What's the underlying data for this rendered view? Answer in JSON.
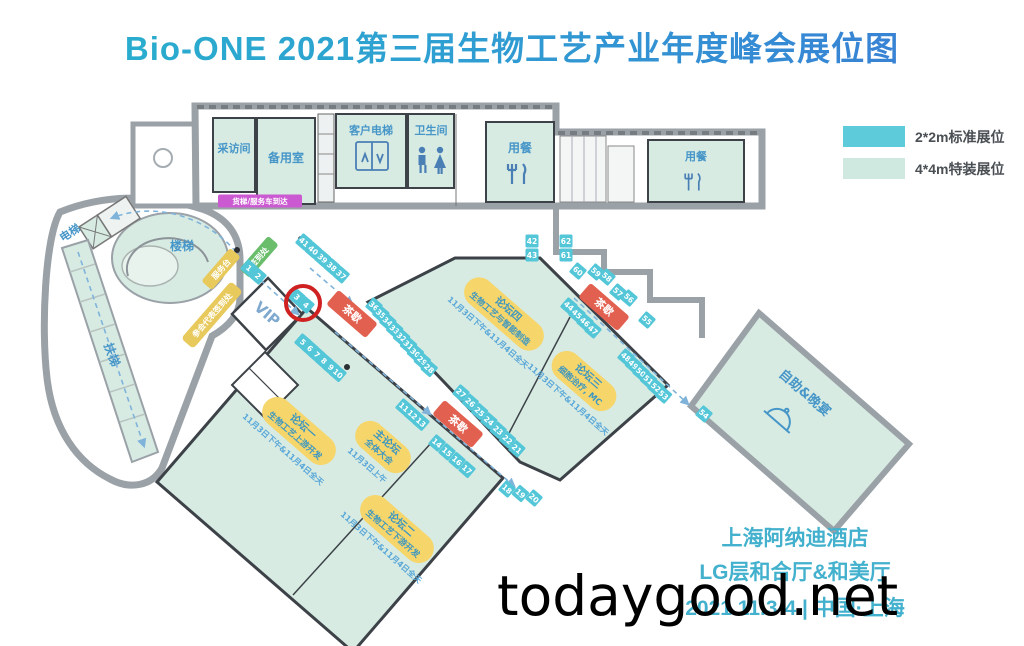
{
  "title": "Bio-ONE 2021第三届生物工艺产业年度峰会展位图",
  "legend": {
    "items": [
      {
        "label": "2*2m标准展位",
        "color": "#5ecbdb"
      },
      {
        "label": "4*4m特装展位",
        "color": "#cfe8e0"
      }
    ]
  },
  "footer": {
    "line1": "上海阿纳迪酒店",
    "line2": "LG层和合厅&和美厅",
    "line3": "2021.11.3-4 | 中国·上海"
  },
  "watermark": "todaygood.net",
  "map": {
    "booth_color": "#53c6d8",
    "wall_gray": "#9aa1a7",
    "room_fill": "#d7ebe3",
    "highlight_color": "#cf2121",
    "rooms": {
      "interview": "采访间",
      "spare": "备用室",
      "elevator_customer": "客户电梯",
      "toilet": "卫生间",
      "dining1": "用餐",
      "dining2": "用餐",
      "elevator": "电梯",
      "stairs": "楼梯",
      "escalator": "扶梯",
      "vip": "VIP",
      "buffet": "自助&晚宴"
    },
    "service_labels": {
      "freight": "货梯/服务车到达",
      "checkin_green": "签到处",
      "service_desk": "服务台",
      "registration": "参会代表签到处"
    },
    "tea_break_label": "茶歇",
    "tea_breaks": [
      {
        "x": 352,
        "y": 314
      },
      {
        "x": 458,
        "y": 424
      },
      {
        "x": 604,
        "y": 307
      }
    ],
    "forums": [
      {
        "name": "论坛一",
        "line2": "生物工艺上游开发",
        "date": "11月3日下午&11月4日全天",
        "x": 299,
        "y": 431,
        "w": 88
      },
      {
        "name": "主论坛",
        "line2": "全体大会",
        "date": "11月3日上午",
        "x": 383,
        "y": 447,
        "w": 64
      },
      {
        "name": "论坛二",
        "line2": "生物工艺下游开发",
        "date": "11月3日下午&11月4日全天",
        "x": 397,
        "y": 529,
        "w": 88
      },
      {
        "name": "论坛四",
        "line2": "生物工艺与智能制造",
        "date": "11月3日下午&11月4日全天",
        "x": 504,
        "y": 314,
        "w": 96
      },
      {
        "name": "论坛三",
        "line2": "细胞治疗, MC",
        "date": "11月3日下午&11月4日全天",
        "x": 584,
        "y": 381,
        "w": 76
      }
    ],
    "booth_strips": [
      {
        "nums": [
          1,
          2
        ],
        "x": 249,
        "y": 268,
        "dx": 9,
        "dy": 8,
        "angle": 41
      },
      {
        "nums": [
          3,
          4
        ],
        "x": 297,
        "y": 297,
        "dx": 9,
        "dy": 8,
        "angle": 41
      },
      {
        "nums": [
          5,
          6,
          7,
          8,
          9,
          10
        ],
        "x": 303,
        "y": 342,
        "dx": 7,
        "dy": 6.3,
        "angle": 41
      },
      {
        "nums": [
          11,
          12,
          13
        ],
        "x": 404,
        "y": 407,
        "dx": 8.5,
        "dy": 7.6,
        "angle": 41
      },
      {
        "nums": [
          14,
          15,
          16,
          17
        ],
        "x": 437,
        "y": 443,
        "dx": 10,
        "dy": 8.8,
        "angle": 41
      },
      {
        "nums": [
          18,
          19,
          20
        ],
        "x": 507,
        "y": 489,
        "dx": 13.5,
        "dy": 4.5,
        "angle": 41
      },
      {
        "nums": [
          27,
          26,
          25,
          24,
          23,
          22,
          21
        ],
        "x": 461,
        "y": 393,
        "dx": 9.3,
        "dy": 9.3,
        "angle": 41
      },
      {
        "nums": [
          36,
          35,
          34,
          33,
          32,
          31,
          30,
          29,
          28
        ],
        "x": 374,
        "y": 306,
        "dx": 6.9,
        "dy": 7.8,
        "angle": 41
      },
      {
        "nums": [
          41,
          40,
          39,
          38,
          37
        ],
        "x": 304,
        "y": 242,
        "dx": 9.3,
        "dy": 8.2,
        "angle": 41
      },
      {
        "nums": [
          42,
          43
        ],
        "x": 532,
        "y": 241,
        "dx": 0,
        "dy": 14,
        "angle": 0
      },
      {
        "nums": [
          62,
          61
        ],
        "x": 566,
        "y": 241,
        "dx": 0,
        "dy": 14,
        "angle": 0
      },
      {
        "nums": [
          60
        ],
        "x": 578,
        "y": 271,
        "dx": 0,
        "dy": 0,
        "angle": 41
      },
      {
        "nums": [
          59,
          58
        ],
        "x": 596,
        "y": 272,
        "dx": 11,
        "dy": 5,
        "angle": 41
      },
      {
        "nums": [
          57,
          56
        ],
        "x": 618,
        "y": 292,
        "dx": 11,
        "dy": 6,
        "angle": 41
      },
      {
        "nums": [
          55
        ],
        "x": 647,
        "y": 320,
        "dx": 0,
        "dy": 0,
        "angle": 41
      },
      {
        "nums": [
          44,
          45,
          46,
          47
        ],
        "x": 569,
        "y": 306,
        "dx": 8,
        "dy": 8,
        "angle": 41
      },
      {
        "nums": [
          48,
          49,
          50,
          51,
          52,
          53
        ],
        "x": 626,
        "y": 357,
        "dx": 7.5,
        "dy": 7.6,
        "angle": 41
      },
      {
        "nums": [
          54
        ],
        "x": 704,
        "y": 414,
        "dx": 0,
        "dy": 0,
        "angle": 41
      }
    ],
    "highlight": {
      "x": 303,
      "y": 303,
      "r": 17
    }
  }
}
